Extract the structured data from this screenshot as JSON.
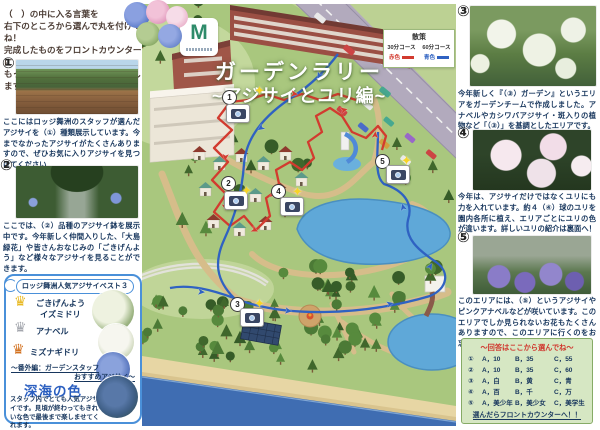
{
  "flyer": {
    "intro_lines": [
      "（　）の中に入る言葉を",
      "右下のところから選んで丸を付けてね！",
      "完成したものをフロントカウンターに",
      "もっていくとプレゼントをお渡しします！"
    ]
  },
  "title": {
    "line1": "ガーデンラリー",
    "line2": "~アジサイとユリ編~"
  },
  "logo": {
    "letter": "M"
  },
  "legend": {
    "title": "散策",
    "course_red": "30分コース",
    "course_blue": "60分コース",
    "label_red": "赤色",
    "label_blue": "青色",
    "color_red": "#d23b2f",
    "color_blue": "#2f62c2"
  },
  "sections": {
    "s1": {
      "num": "①",
      "text": "ここにはロッジ舞洲のスタッフが選んだアジサイを（①）種類展示しています。今までなかったアジサイがたくさんありますので、ぜひお気に入りアジサイを見つけてください"
    },
    "s2": {
      "num": "②",
      "text": "ここでは、（②）品種のアジサイ鉢を展示中です。今年新しく仲間入りした、「大島緑花」や皆さんおなじみの「ごきげんよう」など様々なアジサイを見ることができます。"
    },
    "s3": {
      "num": "③",
      "text": "今年新しく『（③）ガーデン』というエリアをガーデンチームで作成しました。アナベルやカシワバアジサイ・斑入りの植物など「（③）」を基調としたエリアです。"
    },
    "s4": {
      "num": "④",
      "text": "今年は、アジサイだけではなくユリにも力を入れています。約４（④）球のユリを園内各所に植え、エリアごとにユリの色が違います。詳しいユリの紹介は裏面へ！"
    },
    "s5": {
      "num": "⑤",
      "text": "このエリアには、（⑤）というアジサイやピンクアナベルなどが咲いています。このエリアでしか見られないお花もたくさんありますので、このエリアに行くのをお忘れなく！"
    }
  },
  "best3": {
    "title": "ロッジ舞洲人気アジサイベスト３",
    "rank1_name": "ごきげんよう",
    "rank1_name2": "イズミドリ",
    "rank2_name": "アナベル",
    "rank3_name": "ミズナギドリ",
    "extra_label1": "～番外編：ガーデンスタッフ",
    "extra_label2": "おすすめアジサイ～",
    "extra_name": "深海の色",
    "extra_text": "スタッフ内でとても人気アジサイです。見頃が終わってもきれいな色で最後まで楽しませてくれます。"
  },
  "answers": {
    "title": "～回答はここから選んでね～",
    "rows": [
      {
        "num": "①",
        "a": "A，10",
        "b": "B，35",
        "c": "C，55"
      },
      {
        "num": "②",
        "a": "A，10",
        "b": "B，35",
        "c": "C，60"
      },
      {
        "num": "③",
        "a": "A，白",
        "b": "B，黄",
        "c": "C，青"
      },
      {
        "num": "④",
        "a": "A，百",
        "b": "B，千",
        "c": "C，万"
      },
      {
        "num": "⑤",
        "a": "A，美少年",
        "b": "B，美少女",
        "c": "C，美学生"
      }
    ],
    "footer": "選んだらフロントカウンターへ！！"
  },
  "map": {
    "markers": [
      {
        "num": "1"
      },
      {
        "num": "2"
      },
      {
        "num": "3"
      },
      {
        "num": "4"
      },
      {
        "num": "5"
      }
    ]
  },
  "icons": {
    "sparkle": "✦",
    "crown": "♛",
    "arrow": "➤"
  }
}
